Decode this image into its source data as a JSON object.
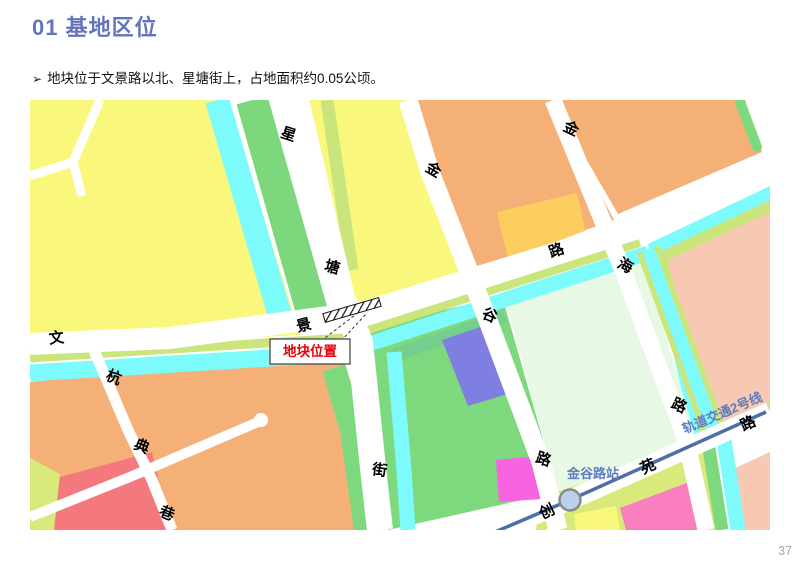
{
  "slide": {
    "title": "01 基地区位",
    "bullet_marker": "➢",
    "bullet_text": "地块位于文景路以北、星塘街上，占地面积约0.05公顷。",
    "page_number": "37"
  },
  "map": {
    "site_callout_label": "地块位置",
    "station_label": "金谷路站",
    "metro_line_label": "轨道交通2号线",
    "road_labels": [
      {
        "road": "xingtang-street",
        "char": "星",
        "x": 287,
        "y": 139,
        "rot": 18
      },
      {
        "road": "xingtang-street",
        "char": "塘",
        "x": 331,
        "y": 272,
        "rot": 15
      },
      {
        "road": "xingtang-street",
        "char": "街",
        "x": 379,
        "y": 475,
        "rot": 8
      },
      {
        "road": "wenjing-road",
        "char": "文",
        "x": 57,
        "y": 343,
        "rot": -6
      },
      {
        "road": "wenjing-road",
        "char": "景",
        "x": 305,
        "y": 330,
        "rot": -14
      },
      {
        "road": "wenjing-road",
        "char": "路",
        "x": 558,
        "y": 255,
        "rot": -20
      },
      {
        "road": "jingu-road",
        "char": "金",
        "x": 431,
        "y": 174,
        "rot": 30
      },
      {
        "road": "jingu-road",
        "char": "谷",
        "x": 488,
        "y": 320,
        "rot": 22
      },
      {
        "road": "jingu-road",
        "char": "路",
        "x": 542,
        "y": 464,
        "rot": 18
      },
      {
        "road": "jinhai-road",
        "char": "金",
        "x": 569,
        "y": 133,
        "rot": 25
      },
      {
        "road": "jinhai-road",
        "char": "海",
        "x": 623,
        "y": 270,
        "rot": 28
      },
      {
        "road": "jinhai-road",
        "char": "路",
        "x": 677,
        "y": 410,
        "rot": 25
      },
      {
        "road": "hangdian-lane",
        "char": "杭",
        "x": 112,
        "y": 382,
        "rot": 22
      },
      {
        "road": "hangdian-lane",
        "char": "典",
        "x": 140,
        "y": 451,
        "rot": 22
      },
      {
        "road": "hangdian-lane",
        "char": "巷",
        "x": 165,
        "y": 518,
        "rot": 22
      },
      {
        "road": "chuangyuan-road",
        "char": "创",
        "x": 549,
        "y": 516,
        "rot": -25
      },
      {
        "road": "chuangyuan-road",
        "char": "苑",
        "x": 650,
        "y": 471,
        "rot": -25
      },
      {
        "road": "chuangyuan-road",
        "char": "路",
        "x": 750,
        "y": 428,
        "rot": -25
      }
    ],
    "palette": {
      "yellow": "#F9F87D",
      "olive": "#CBE57D",
      "green_band": "#7CD77D",
      "water_cyan": "#7DFBFC",
      "orange": "#F5B078",
      "gold": "#FBCE5F",
      "pale_mint": "#E7F8E4",
      "green_parcel": "#7ED97E",
      "purple": "#7F7FE2",
      "pink_peach": "#F7C9B3",
      "red": "#F4797E",
      "magenta": "#F763E0",
      "rose": "#FA7FBE",
      "yellow_green": "#D9E97C",
      "metro_blue": "#4C6FA8",
      "station_fill": "#BDD0E9",
      "label_blue": "#5F7CBF",
      "title_blue": "#6374BC",
      "callout_red": "#E8000D",
      "page_gray": "#A6A6A6"
    }
  }
}
